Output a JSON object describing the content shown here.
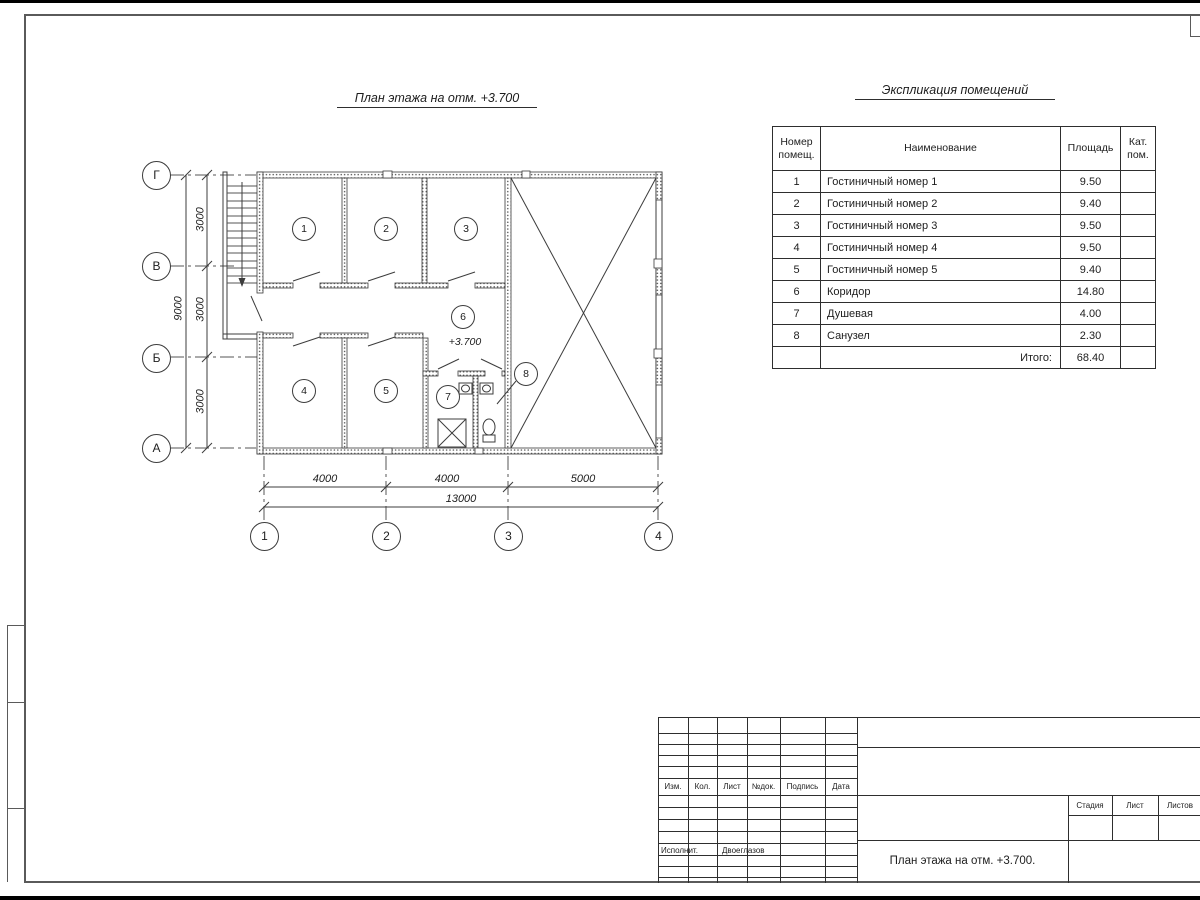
{
  "plan": {
    "title": "План этажа на отм. +3.700",
    "elevation_label": "+3.700",
    "room_bubbles": [
      "1",
      "2",
      "3",
      "4",
      "5",
      "6",
      "7",
      "8"
    ]
  },
  "axes": {
    "row_labels": [
      "Г",
      "В",
      "Б",
      "А"
    ],
    "col_labels": [
      "1",
      "2",
      "3",
      "4"
    ],
    "v_dims": [
      "3000",
      "3000",
      "3000"
    ],
    "v_total": "9000",
    "h_dims": [
      "4000",
      "4000",
      "5000"
    ],
    "h_total": "13000"
  },
  "schedule": {
    "title": "Экспликация помещений",
    "col_num": "Номер помещ.",
    "col_name": "Наименование",
    "col_area": "Площадь",
    "col_cat": "Кат. пом.",
    "rows": [
      {
        "num": "1",
        "name": "Гостиничный номер 1",
        "area": "9.50"
      },
      {
        "num": "2",
        "name": "Гостиничный номер 2",
        "area": "9.40"
      },
      {
        "num": "3",
        "name": "Гостиничный номер 3",
        "area": "9.50"
      },
      {
        "num": "4",
        "name": "Гостиничный номер 4",
        "area": "9.50"
      },
      {
        "num": "5",
        "name": "Гостиничный номер 5",
        "area": "9.40"
      },
      {
        "num": "6",
        "name": "Коридор",
        "area": "14.80"
      },
      {
        "num": "7",
        "name": "Душевая",
        "area": "4.00"
      },
      {
        "num": "8",
        "name": "Санузел",
        "area": "2.30"
      }
    ],
    "total_label": "Итого:",
    "total_value": "68.40"
  },
  "titleblock": {
    "change_cols": [
      "Изм.",
      "Кол.",
      "Лист",
      "№док.",
      "Подпись",
      "Дата"
    ],
    "executor_label": "Исполнит.",
    "executor_name": "Двоеглазов",
    "doc_title": "План этажа на отм. +3.700.",
    "stage": "Стадия",
    "sheet": "Лист",
    "sheets": "Листов"
  }
}
